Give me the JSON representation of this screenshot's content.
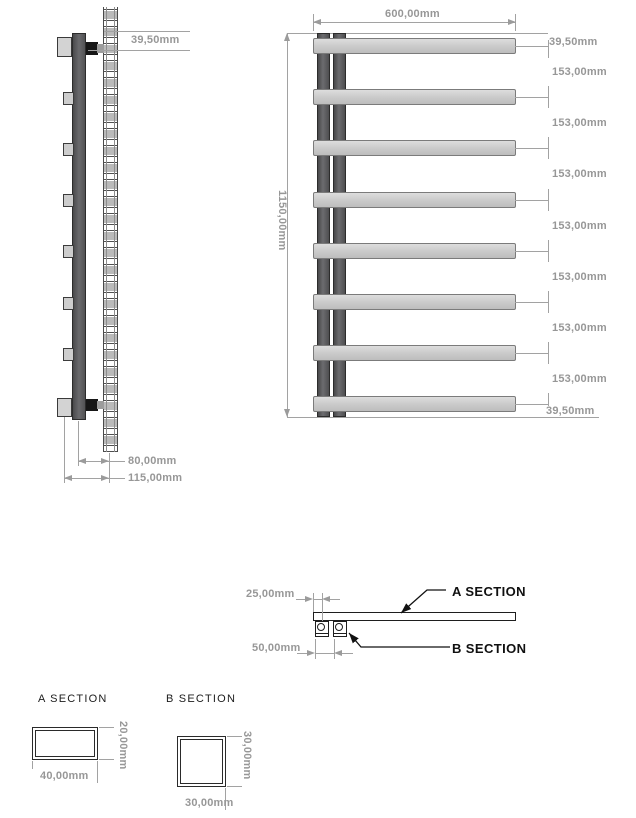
{
  "side_view": {
    "top_dim": "39,50mm",
    "depth_dim": "80,00mm",
    "total_depth_dim": "115,00mm"
  },
  "front_view": {
    "width_dim": "600,00mm",
    "height_dim": "1150,00mm",
    "top_offset_dim": "39,50mm",
    "bottom_offset_dim": "39,50mm",
    "spacing_dims": [
      "153,00mm",
      "153,00mm",
      "153,00mm",
      "153,00mm",
      "153,00mm",
      "153,00mm",
      "153,00mm"
    ]
  },
  "section_callouts": {
    "offset_dim": "25,00mm",
    "tube_pitch_dim": "50,00mm",
    "a_label": "A SECTION",
    "b_label": "B SECTION"
  },
  "detail_a": {
    "title": "A SECTION",
    "width_dim": "40,00mm",
    "height_dim": "20,00mm"
  },
  "detail_b": {
    "title": "B SECTION",
    "width_dim": "30,00mm",
    "height_dim": "30,00mm"
  },
  "colors": {
    "dimension": "#979797",
    "outline": "#1e1e1e",
    "column": "#58585a",
    "rail": "#cccccc"
  }
}
